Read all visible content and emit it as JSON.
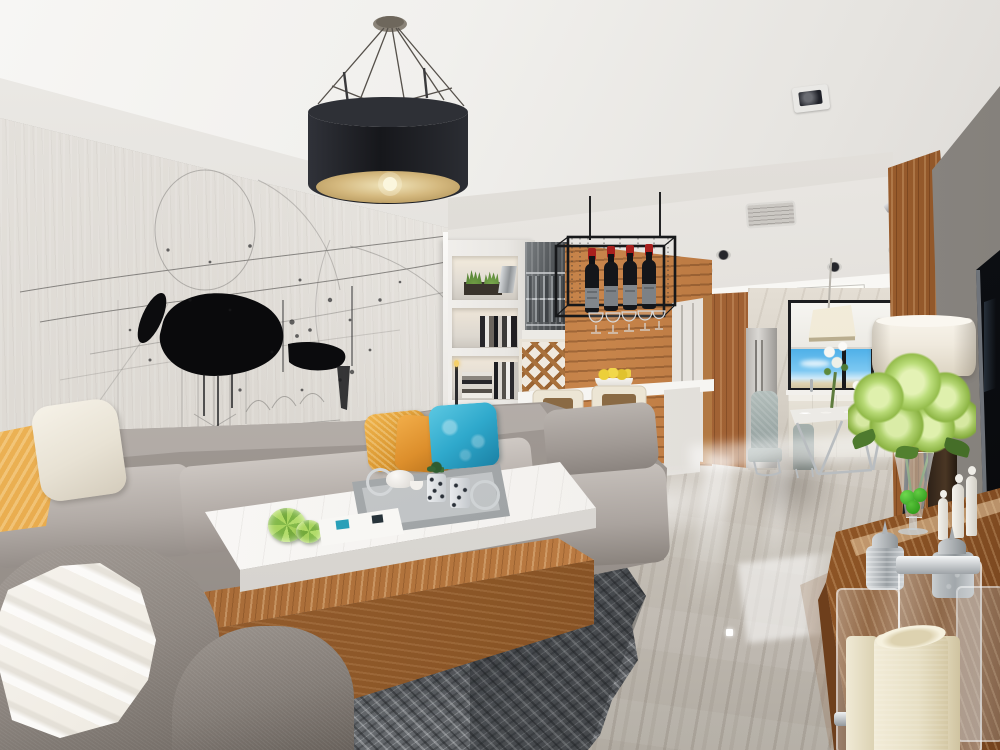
{
  "scene": {
    "title": "Modern living room interior rendering",
    "style": "contemporary apartment, open plan living / bar / dining",
    "no_visible_text": true
  },
  "palette": {
    "ceiling_white": "#f3f2f0",
    "wall_plaster": "#dedbd6",
    "art_ink_black": "#0a0a0c",
    "pendant_shade_black": "#1d1f24",
    "pendant_inner_gold": "#cfb379",
    "sofa_gray": "#a8a19b",
    "pillow_orange": "#e09a3c",
    "pillow_teal": "#2fa9cc",
    "pillow_cream": "#ece7db",
    "wood_warm": "#a9673a",
    "coffee_table_white": "#f7f6f4",
    "rug_gray": "#6f7377",
    "floor_tile": "#bfb9b0",
    "sky_blue": "#59b7ec",
    "counter_white": "#f0efec",
    "wine_rack_black": "#17181a",
    "wine_cap_red": "#a8201e",
    "hydrangea_green": "#b8d879",
    "candle_cream": "#efe8d2",
    "chrome": "#c9cdd0",
    "tv_black": "#0b0d11"
  },
  "objects": {
    "pendant_lamp": "black drum pendant lamp with gold liner",
    "wall_art": "abstract black ink architectural sketch mural",
    "sofa": "light gray sectional sofa",
    "pillow_orange_left": "orange satin pillow",
    "pillow_cream_left": "cream pillow",
    "pillow_gold": "gold weave pillow",
    "pillow_orange_mid": "orange pillow",
    "pillow_teal": "teal mottled pillow",
    "coffee_table": "white slab coffee table on walnut base",
    "tray": "gray serving tray with chrome handles",
    "succulent": "green succulent rosettes",
    "magazine": "open magazine",
    "rug": "gray shag rug",
    "armchair_left": "gray armchair with white satin pillow",
    "armchair_right": "gray armchair seen from behind",
    "shelving": "white built-in display shelving with plants and books",
    "mirror_cabinet": "mirrored bar cabinet with glassware",
    "wine_lattice": "X lattice wine cubby",
    "wine_rack": "hanging black wire wine rack with bottles and stemware",
    "bar_counter": "white bar counter",
    "fruit_bowl": "bowl of yellow fruit",
    "bar_stools": "two wooden bar stools with cream cushions",
    "door": "white interior door with wood frame",
    "fridge": "stainless refrigerator",
    "kitchen_window": "kitchen window with roller shade and sea view",
    "dining_table": "white dining table with chrome legs",
    "dining_chairs": "gray upholstered dining chairs",
    "kitchen_pendant": "cream square kitchen pendant",
    "ceiling_vent": "linear AC vent grille",
    "spotlights": "recessed ceiling spotlights",
    "track_light": "track spotlight fixture",
    "wood_column": "vertical wood paneled column",
    "tv": "wall mounted TV edge",
    "floor_lamp": "tripod floor lamp with white drum shade",
    "hydrangeas": "green hydrangea bouquet in glass vase",
    "console_table": "walnut console table",
    "hurricane_candles": "glass hurricane holders with white pillar candles",
    "figurines": "white ceramic figurines",
    "silver_jars": "silver lidded jars",
    "floor": "glossy gray wood-look tile floor"
  }
}
